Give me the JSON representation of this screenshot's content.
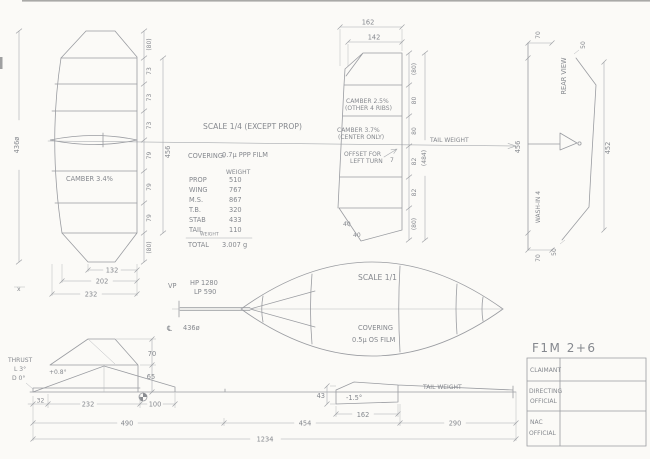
{
  "notes": {
    "scale_main": "SCALE 1/4 (EXCEPT PROP)",
    "covering_label": "COVERING:",
    "covering_value": "0.7μ PPP FILM"
  },
  "wing": {
    "span_dim": "436ø",
    "rib_dims": [
      "(80)",
      "73",
      "73",
      "73",
      "79",
      "79",
      "79",
      "(80)"
    ],
    "panel_span": "456",
    "camber_note": "CAMBER 3.4%",
    "chord_dims": {
      "tip": "132",
      "mid": "202",
      "root": "232"
    },
    "section_mark": "x"
  },
  "stab": {
    "chord_dims": {
      "outer": "162",
      "inner": "142"
    },
    "rib_dims": [
      "(80)",
      "80",
      "80",
      "82",
      "82",
      "(80)"
    ],
    "overall_span": "(484)",
    "camber_note1a": "CAMBER 2.5%",
    "camber_note1b": "(OTHER 4 RIBS)",
    "camber_note2a": "CAMBER 3.7%",
    "camber_note2b": "(CENTER ONLY)",
    "offset_note1": "OFFSET FOR",
    "offset_note2": "LEFT TURN",
    "offset_value": "7",
    "tip_angle1": "40",
    "tip_angle2": "40",
    "tail_weight_label": "TAIL WEIGHT"
  },
  "rear_view": {
    "label": "REAR VIEW",
    "span_dim": "456",
    "outline_dim": "452",
    "tip_dim_top": "70",
    "tip_dim_bottom": "70",
    "tip_rise_top": "50",
    "tip_rise_bottom": "50",
    "wash_in": "WASH-IN 4"
  },
  "weights": {
    "header": "WEIGHT",
    "rows": [
      {
        "label": "PROP",
        "value": "510"
      },
      {
        "label": "WING",
        "value": "767"
      },
      {
        "label": "M.S.",
        "value": "867"
      },
      {
        "label": "T.B.",
        "value": "320"
      },
      {
        "label": "STAB",
        "value": "433"
      },
      {
        "label": "TAIL",
        "sub": "WEIGHT",
        "value": "110"
      }
    ],
    "total_label": "TOTAL",
    "total_value": "3.007 g"
  },
  "prop": {
    "scale": "SCALE 1/1",
    "vp": "VP",
    "hp": "HP 1280",
    "lp": "LP 590",
    "cl_symbol": "℄",
    "diameter": "436ø",
    "covering1": "COVERING",
    "covering2": "0.5μ OS FILM"
  },
  "side_view": {
    "thrust1": "THRUST",
    "thrust2": "L 3°",
    "thrust3": "D 0°",
    "wing_incidence": "+0.8°",
    "stab_incidence": "-1.5°",
    "tail_weight_label": "TAIL WEIGHT",
    "dims": {
      "nose": "32",
      "wing_mount": "232",
      "wing_te": "100",
      "pylon_h": "70",
      "wing_h": "65",
      "ms": "490",
      "mid": "454",
      "tail": "290",
      "total": "1234",
      "stab_h": "43",
      "stab_chord": "162"
    }
  },
  "title_block": {
    "title": "F1M 2+6",
    "row1": "CLAIMANT",
    "row2a": "DIRECTING",
    "row2b": "OFFICIAL",
    "row3a": "NAC",
    "row3b": "OFFICIAL"
  }
}
